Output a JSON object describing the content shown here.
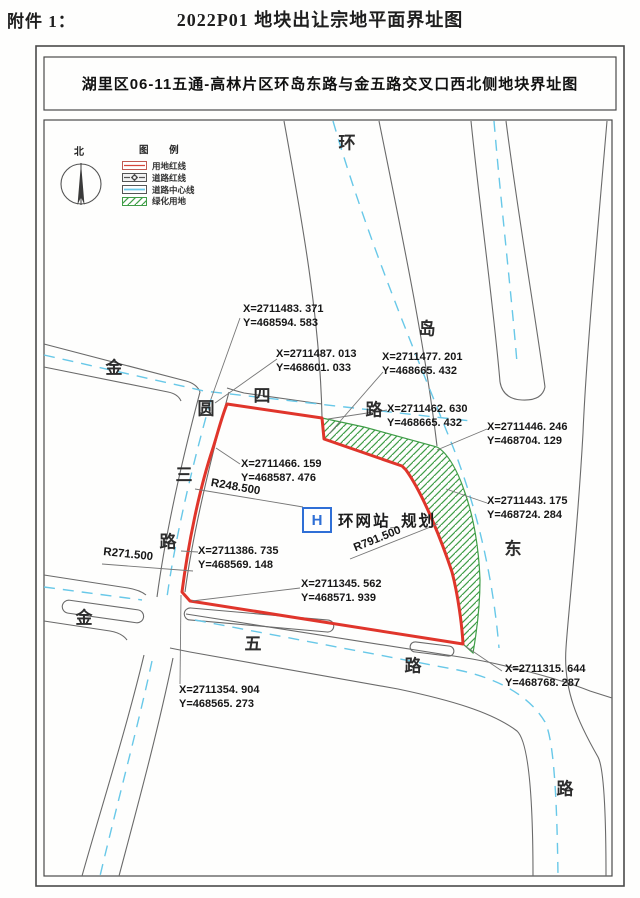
{
  "page": {
    "attachment_label": "附件 1：",
    "title": "2022P01 地块出让宗地平面界址图"
  },
  "map": {
    "title": "湖里区06-11五通-高林片区环岛东路与金五路交叉口西北侧地块界址图",
    "north_label": "北",
    "legend": {
      "title": "图  例",
      "items": [
        {
          "label": "用地红线",
          "swatch": "red-boundary-swatch"
        },
        {
          "label": "道路红线",
          "swatch": "road-redline-swatch"
        },
        {
          "label": "道路中心线",
          "swatch": "road-centerline-swatch"
        },
        {
          "label": "绿化用地",
          "swatch": "green-area-swatch"
        }
      ]
    },
    "site": {
      "marker": "H",
      "label": "环网站_规划"
    },
    "radii": [
      {
        "text": "R248.500"
      },
      {
        "text": "R271.500"
      },
      {
        "text": "R791.500"
      }
    ],
    "roads": {
      "ring": [
        "环",
        "岛",
        "东",
        "路"
      ],
      "jinsi": [
        "金",
        "四",
        "路"
      ],
      "yuansan": [
        "圆",
        "三",
        "路"
      ],
      "jinwu": [
        "金",
        "五",
        "路"
      ]
    },
    "coords": [
      {
        "x": "X=2711483. 371",
        "y": "Y=468594. 583"
      },
      {
        "x": "X=2711487. 013",
        "y": "Y=468601. 033"
      },
      {
        "x": "X=2711477. 201",
        "y": "Y=468665. 432"
      },
      {
        "x": "X=2711462. 630",
        "y": "Y=468665. 432"
      },
      {
        "x": "X=2711446. 246",
        "y": "Y=468704. 129"
      },
      {
        "x": "X=2711443. 175",
        "y": "Y=468724. 284"
      },
      {
        "x": "X=2711466. 159",
        "y": "Y=468587. 476"
      },
      {
        "x": "X=2711386. 735",
        "y": "Y=468569. 148"
      },
      {
        "x": "X=2711345. 562",
        "y": "Y=468571. 939"
      },
      {
        "x": "X=2711354. 904",
        "y": "Y=468565. 273"
      },
      {
        "x": "X=2711315. 644",
        "y": "Y=468768. 287"
      }
    ],
    "colors": {
      "parcel_red": "#e0352b",
      "center_cyan": "#68c8e8",
      "road_gray": "#6a6a6a",
      "hatch_green": "#3f9d47",
      "marker_blue": "#2f6fd6"
    }
  }
}
